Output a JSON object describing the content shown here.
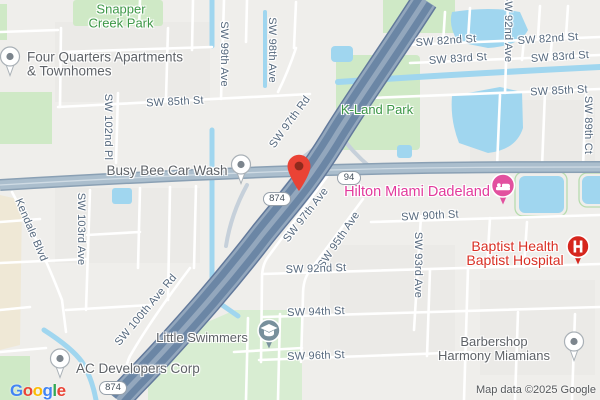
{
  "app": "google-maps-embed",
  "attribution": "Map data ©2025 Google",
  "logo": [
    "G",
    "o",
    "o",
    "g",
    "l",
    "e"
  ],
  "logo_colors": [
    "#4285F4",
    "#EA4335",
    "#FBBC05",
    "#4285F4",
    "#34A853",
    "#EA4335"
  ],
  "shields": {
    "sr94": "94",
    "sr874": "874"
  },
  "streets": [
    "SW 82nd St",
    "SW 82nd St",
    "SW 83rd St",
    "SW 83rd St",
    "SW 85th St",
    "SW 85th St",
    "SW 92nd Ave",
    "SW 99th Ave",
    "SW 98th Ave",
    "SW 102nd Pl",
    "SW 103rd Ave",
    "SW 89th Ct",
    "SW 93rd Ave",
    "SW 97th Rd",
    "SW 97th Ave",
    "SW 95th Ave",
    "SW 100th Ave Rd",
    "Kendale Blvd",
    "SW 90th St",
    "SW 92nd St",
    "SW 94th St",
    "SW 96th St"
  ],
  "pois": {
    "snapper": [
      "Snapper",
      "Creek Park"
    ],
    "kland": "K-Land Park",
    "four_quarters": [
      "Four Quarters Apartments",
      "& Townhomes"
    ],
    "busy_bee": "Busy Bee Car Wash",
    "hilton": "Hilton Miami Dadeland",
    "baptist": [
      "Baptist Health",
      "Baptist Hospital"
    ],
    "little_swimmers": "Little Swimmers",
    "ac_dev": "AC Developers Corp",
    "barbershop": [
      "Barbershop",
      "Harmony Miamians"
    ]
  },
  "colors": {
    "background": "#efeeeb",
    "water": "#a0d6ef",
    "park_fill": "#cfe9c6",
    "park_label": "#3d9747",
    "street_label": "#56697e",
    "poi_label": "#5f6368",
    "hotel_pink": "#e23a9c",
    "hospital_red": "#d93025",
    "destination_pin": "#EA4335",
    "highway_fill": "#93a7bd",
    "highway_lane": "#6b86a5",
    "major_road": "#abbecd"
  }
}
